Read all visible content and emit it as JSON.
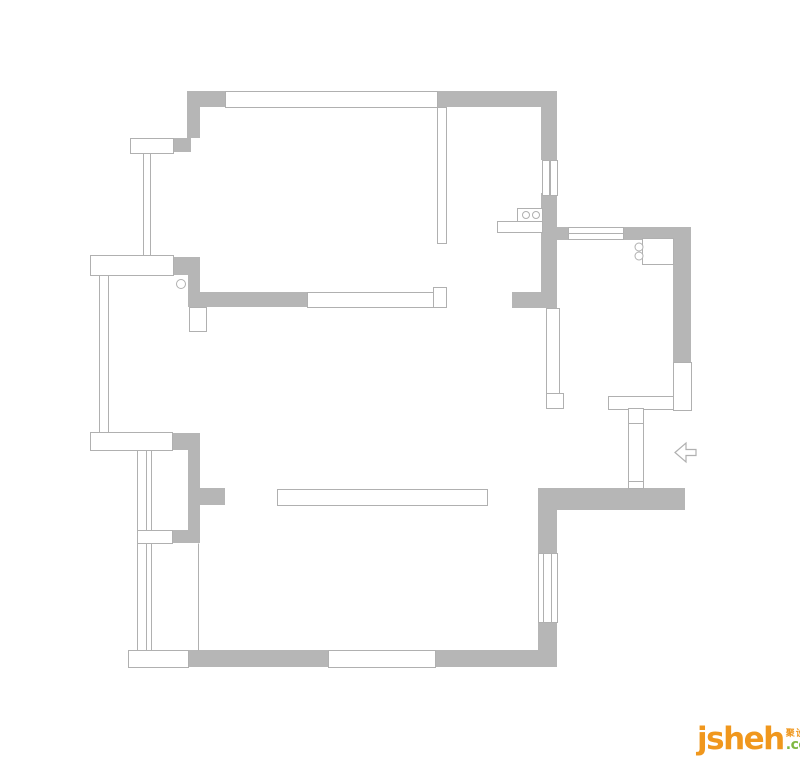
{
  "page": {
    "width": 800,
    "height": 765,
    "background": "#ffffff"
  },
  "colors": {
    "wall_fill": "#b6b6b6",
    "outline": "#b0b0b0",
    "logo_orange": "#f0971d",
    "logo_green": "#7fb842"
  },
  "logo": {
    "brand": "jsheh",
    "tld": ".com",
    "cjk": "聚设汇"
  },
  "floorplan": {
    "walls": [
      {
        "x": 187,
        "y": 91,
        "w": 38,
        "h": 16,
        "name": "north-wall-left"
      },
      {
        "x": 437,
        "y": 91,
        "w": 120,
        "h": 16,
        "name": "north-wall-right"
      },
      {
        "x": 187,
        "y": 107,
        "w": 13,
        "h": 31,
        "name": "west-wall-upper"
      },
      {
        "x": 173,
        "y": 138,
        "w": 18,
        "h": 14,
        "name": "balcony-anchor-top"
      },
      {
        "x": 173,
        "y": 257,
        "w": 27,
        "h": 18,
        "name": "bay-anchor-upper"
      },
      {
        "x": 188,
        "y": 275,
        "w": 12,
        "h": 32,
        "name": "west-wall-mid"
      },
      {
        "x": 200,
        "y": 292,
        "w": 107,
        "h": 15,
        "name": "bedroom-south-wall"
      },
      {
        "x": 541,
        "y": 107,
        "w": 16,
        "h": 53,
        "name": "kitchen-west-wall-upper"
      },
      {
        "x": 541,
        "y": 193,
        "w": 16,
        "h": 115,
        "name": "kitchen-west-wall-lower"
      },
      {
        "x": 512,
        "y": 292,
        "w": 30,
        "h": 16,
        "name": "dining-wall-stub"
      },
      {
        "x": 557,
        "y": 227,
        "w": 12,
        "h": 13,
        "name": "kitchen-north-wall-left"
      },
      {
        "x": 623,
        "y": 227,
        "w": 68,
        "h": 13,
        "name": "kitchen-north-wall-right"
      },
      {
        "x": 673,
        "y": 240,
        "w": 18,
        "h": 122,
        "name": "kitchen-east-wall"
      },
      {
        "x": 172,
        "y": 433,
        "w": 28,
        "h": 17,
        "name": "bay-anchor-mid"
      },
      {
        "x": 188,
        "y": 445,
        "w": 12,
        "h": 85,
        "name": "west-wall-lower"
      },
      {
        "x": 200,
        "y": 488,
        "w": 25,
        "h": 17,
        "name": "living-wall-stub"
      },
      {
        "x": 172,
        "y": 530,
        "w": 28,
        "h": 13,
        "name": "bay-anchor-low"
      },
      {
        "x": 188,
        "y": 650,
        "w": 140,
        "h": 17,
        "name": "south-wall-left"
      },
      {
        "x": 435,
        "y": 650,
        "w": 122,
        "h": 17,
        "name": "south-wall-right"
      },
      {
        "x": 538,
        "y": 490,
        "w": 19,
        "h": 63,
        "name": "east-wall-upper"
      },
      {
        "x": 538,
        "y": 622,
        "w": 19,
        "h": 45,
        "name": "east-wall-lower"
      },
      {
        "x": 538,
        "y": 488,
        "w": 147,
        "h": 22,
        "name": "entry-south-wall"
      }
    ],
    "outlines": [
      {
        "x": 225,
        "y": 91,
        "w": 212,
        "h": 16,
        "name": "north-window"
      },
      {
        "x": 130,
        "y": 138,
        "w": 43,
        "h": 15,
        "name": "balcony-slab-top"
      },
      {
        "x": 90,
        "y": 255,
        "w": 83,
        "h": 20,
        "name": "bay-slab-upper"
      },
      {
        "x": 90,
        "y": 432,
        "w": 82,
        "h": 18,
        "name": "bay-slab-mid"
      },
      {
        "x": 137,
        "y": 530,
        "w": 35,
        "h": 13,
        "name": "bay-divider"
      },
      {
        "x": 128,
        "y": 650,
        "w": 60,
        "h": 17,
        "name": "bay-slab-bottom"
      },
      {
        "x": 307,
        "y": 292,
        "w": 131,
        "h": 15,
        "name": "bedroom-south-opening"
      },
      {
        "x": 433,
        "y": 287,
        "w": 13,
        "h": 20,
        "name": "partition-notch"
      },
      {
        "x": 437,
        "y": 107,
        "w": 9,
        "h": 136,
        "name": "bedroom-partition"
      },
      {
        "x": 189,
        "y": 307,
        "w": 17,
        "h": 24,
        "name": "west-wall-jamb"
      },
      {
        "x": 542,
        "y": 160,
        "w": 7,
        "h": 35,
        "name": "kitchen-west-window-a"
      },
      {
        "x": 550,
        "y": 160,
        "w": 7,
        "h": 35,
        "name": "kitchen-west-window-b"
      },
      {
        "x": 568,
        "y": 227,
        "w": 55,
        "h": 12,
        "name": "kitchen-north-window"
      },
      {
        "x": 546,
        "y": 308,
        "w": 13,
        "h": 85,
        "name": "hall-thin-wall"
      },
      {
        "x": 546,
        "y": 393,
        "w": 17,
        "h": 15,
        "name": "hall-thin-wall-foot"
      },
      {
        "x": 608,
        "y": 396,
        "w": 83,
        "h": 13,
        "name": "entry-north-wall"
      },
      {
        "x": 673,
        "y": 362,
        "w": 18,
        "h": 48,
        "name": "east-wall-outline"
      },
      {
        "x": 628,
        "y": 408,
        "w": 15,
        "h": 80,
        "name": "entry-door"
      },
      {
        "x": 277,
        "y": 489,
        "w": 210,
        "h": 16,
        "name": "living-beam"
      },
      {
        "x": 328,
        "y": 650,
        "w": 107,
        "h": 17,
        "name": "south-window"
      },
      {
        "x": 538,
        "y": 553,
        "w": 19,
        "h": 69,
        "name": "east-window"
      },
      {
        "x": 517,
        "y": 208,
        "w": 25,
        "h": 15,
        "name": "cooktop"
      },
      {
        "x": 497,
        "y": 221,
        "w": 45,
        "h": 11,
        "name": "cooktop-counter"
      },
      {
        "x": 642,
        "y": 238,
        "w": 31,
        "h": 26,
        "name": "sink-counter"
      }
    ],
    "lines": [
      {
        "x1": 143,
        "y1": 153,
        "x2": 143,
        "y2": 255,
        "name": "balcony-glazing-1"
      },
      {
        "x1": 150,
        "y1": 153,
        "x2": 150,
        "y2": 255,
        "name": "balcony-glazing-2"
      },
      {
        "x1": 99,
        "y1": 275,
        "x2": 99,
        "y2": 432,
        "name": "bay-glazing-1"
      },
      {
        "x1": 108,
        "y1": 275,
        "x2": 108,
        "y2": 432,
        "name": "bay-glazing-2"
      },
      {
        "x1": 137,
        "y1": 450,
        "x2": 137,
        "y2": 650,
        "name": "bay-outer-face"
      },
      {
        "x1": 146,
        "y1": 450,
        "x2": 146,
        "y2": 530,
        "name": "bay-glazing-3"
      },
      {
        "x1": 151,
        "y1": 450,
        "x2": 151,
        "y2": 530,
        "name": "bay-glazing-4"
      },
      {
        "x1": 146,
        "y1": 543,
        "x2": 146,
        "y2": 650,
        "name": "bay-glazing-5"
      },
      {
        "x1": 151,
        "y1": 543,
        "x2": 151,
        "y2": 650,
        "name": "bay-glazing-6"
      },
      {
        "x1": 198,
        "y1": 543,
        "x2": 198,
        "y2": 650,
        "name": "bay-inner-face"
      },
      {
        "x1": 568,
        "y1": 233,
        "x2": 623,
        "y2": 233,
        "name": "kitchen-north-window-mullion"
      },
      {
        "x1": 543,
        "y1": 553,
        "x2": 543,
        "y2": 622,
        "name": "east-window-glazing-1"
      },
      {
        "x1": 551,
        "y1": 553,
        "x2": 551,
        "y2": 622,
        "name": "east-window-glazing-2"
      },
      {
        "x1": 628,
        "y1": 423,
        "x2": 643,
        "y2": 423,
        "name": "entry-door-tick-top"
      },
      {
        "x1": 628,
        "y1": 481,
        "x2": 643,
        "y2": 481,
        "name": "entry-door-tick-bottom"
      }
    ],
    "circles": [
      {
        "cx": 181,
        "cy": 284,
        "r": 4.5,
        "name": "bedroom-door-pivot"
      },
      {
        "cx": 639,
        "cy": 247,
        "r": 4,
        "name": "sink-circle-1"
      },
      {
        "cx": 639,
        "cy": 256,
        "r": 4,
        "name": "sink-circle-2"
      },
      {
        "cx": 526,
        "cy": 215,
        "r": 3.5,
        "name": "cooktop-burner-1"
      },
      {
        "cx": 536,
        "cy": 215,
        "r": 3.5,
        "name": "cooktop-burner-2"
      }
    ],
    "entry_arrow_points": "675,452.5 686,443 686,449.5 696,449.5 696,455.5 686,455.5 686,462"
  }
}
